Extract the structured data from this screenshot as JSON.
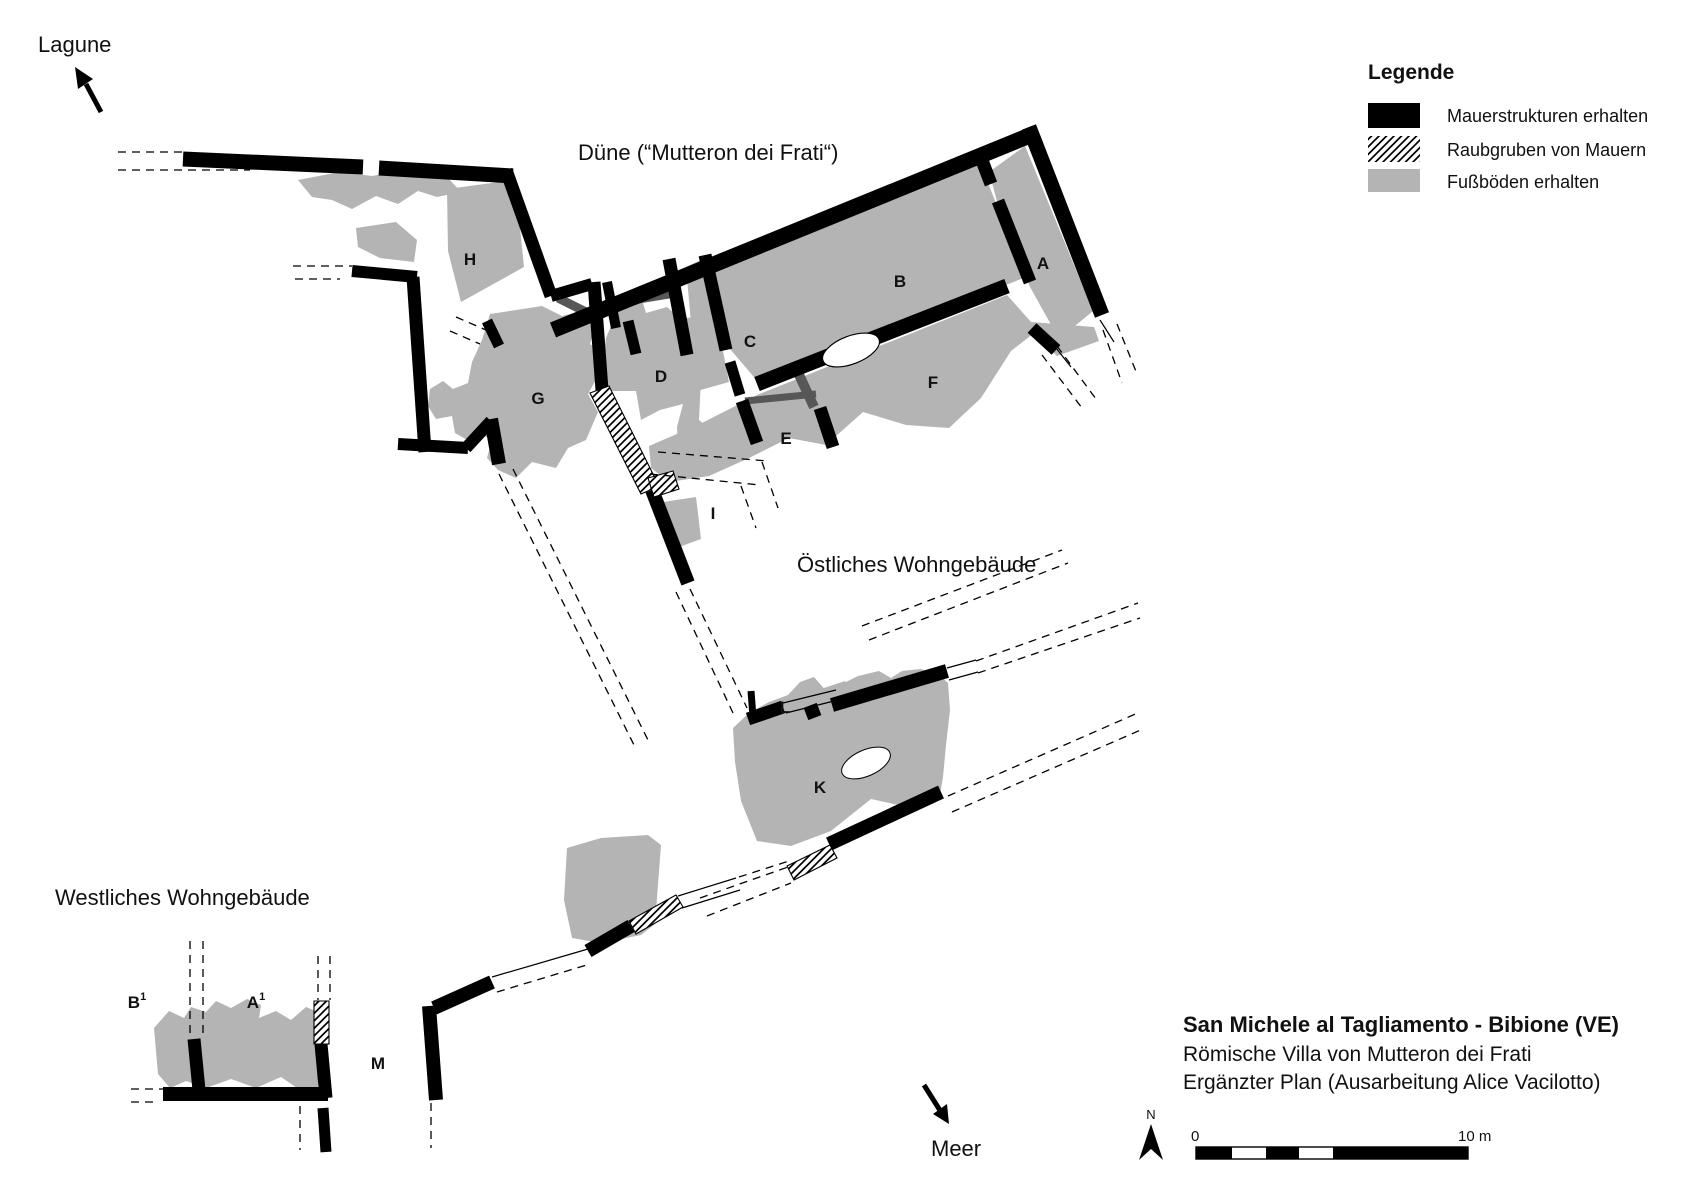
{
  "legend": {
    "title": "Legende",
    "items": [
      {
        "swatch": "solid-black",
        "label": "Mauerstrukturen erhalten"
      },
      {
        "swatch": "hatched",
        "label": "Raubgruben von Mauern"
      },
      {
        "swatch": "gray",
        "label": "Fußböden erhalten"
      }
    ]
  },
  "title_block": {
    "line1": "San Michele al Tagliamento - Bibione (VE)",
    "line2": "Römische Villa von Mutteron dei Frati",
    "line3": "Ergänzter Plan (Ausarbeitung Alice Vacilotto)"
  },
  "area_labels": {
    "lagune": "Lagune",
    "duene": "Düne (“Mutteron dei Frati“)",
    "east_building": "Östliches Wohngebäude",
    "west_building": "Westliches Wohngebäude",
    "meer": "Meer"
  },
  "rooms": [
    {
      "label": "A"
    },
    {
      "label": "B"
    },
    {
      "label": "C"
    },
    {
      "label": "D"
    },
    {
      "label": "E"
    },
    {
      "label": "F"
    },
    {
      "label": "G"
    },
    {
      "label": "H"
    },
    {
      "label": "I"
    },
    {
      "label": "K"
    },
    {
      "label": "L"
    },
    {
      "label": "M"
    },
    {
      "label": "A",
      "sup": "1"
    },
    {
      "label": "B",
      "sup": "1"
    }
  ],
  "compass": {
    "north_label": "N"
  },
  "scale_bar": {
    "zero_label": "0",
    "max_label": "10 m"
  },
  "colors": {
    "wall": "#000000",
    "wall_shadow": "#575757",
    "floor": "#b4b4b4",
    "background": "#ffffff"
  }
}
